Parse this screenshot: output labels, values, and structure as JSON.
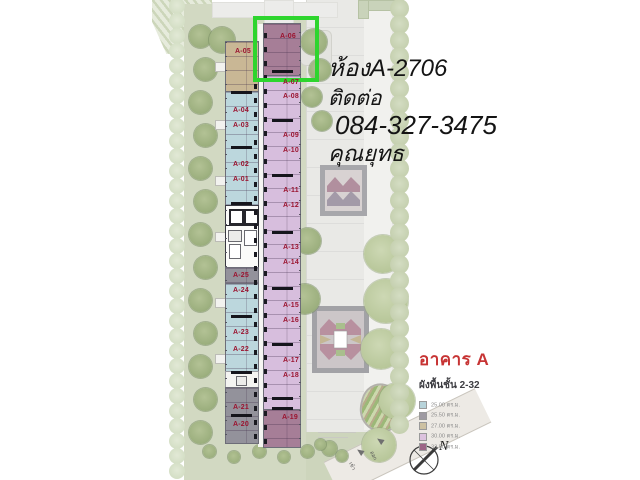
{
  "overlay": {
    "room_line": "ห้องA-2706",
    "contact_line": "ติดต่อ",
    "phone": "084-327-3475",
    "name": "คุณยุทธ"
  },
  "legend": {
    "building_title": "อาคาร A",
    "floors_subtitle": "ผังพื้นชั้น 2-32",
    "accent_color": "#c73434",
    "items": [
      {
        "label": "25.00 ตร.ม.",
        "color": "#b7d3da"
      },
      {
        "label": "25.50 ตร.ม.",
        "color": "#9e9aa2"
      },
      {
        "label": "27.00 ตร.ม.",
        "color": "#cdc1a2"
      },
      {
        "label": "30.00 ตร.ม.",
        "color": "#dcc2de"
      },
      {
        "label": "33.50 ตร.ม.",
        "color": "#9c6586"
      }
    ]
  },
  "site": {
    "compass_label": "N",
    "entrance_label": "เข้า",
    "exit_label": "ออก"
  },
  "highlight": {
    "unit": "A-06",
    "color": "#2ed52e"
  },
  "units": {
    "left": [
      {
        "id": "A-05",
        "type": "tan",
        "x": 232,
        "y": 48
      },
      {
        "id": "A-04",
        "type": "blue",
        "x": 230,
        "y": 107
      },
      {
        "id": "A-03",
        "type": "blue",
        "x": 230,
        "y": 122
      },
      {
        "id": "A-02",
        "type": "blue",
        "x": 230,
        "y": 161
      },
      {
        "id": "A-01",
        "type": "blue",
        "x": 230,
        "y": 176
      },
      {
        "id": "A-25",
        "type": "gray",
        "x": 230,
        "y": 272
      },
      {
        "id": "A-24",
        "type": "blue",
        "x": 230,
        "y": 287
      },
      {
        "id": "A-23",
        "type": "blue",
        "x": 230,
        "y": 329
      },
      {
        "id": "A-22",
        "type": "blue",
        "x": 230,
        "y": 346
      },
      {
        "id": "A-21",
        "type": "gray",
        "x": 230,
        "y": 404
      },
      {
        "id": "A-20",
        "type": "gray",
        "x": 230,
        "y": 421
      }
    ],
    "right": [
      {
        "id": "A-06",
        "type": "mauve",
        "x": 277,
        "y": 33
      },
      {
        "id": "A-07",
        "type": "purple",
        "x": 280,
        "y": 79
      },
      {
        "id": "A-08",
        "type": "purple",
        "x": 280,
        "y": 93
      },
      {
        "id": "A-09",
        "type": "purple",
        "x": 280,
        "y": 132
      },
      {
        "id": "A-10",
        "type": "purple",
        "x": 280,
        "y": 147
      },
      {
        "id": "A-11",
        "type": "purple",
        "x": 280,
        "y": 187
      },
      {
        "id": "A-12",
        "type": "purple",
        "x": 280,
        "y": 202
      },
      {
        "id": "A-13",
        "type": "purple",
        "x": 280,
        "y": 244
      },
      {
        "id": "A-14",
        "type": "purple",
        "x": 280,
        "y": 259
      },
      {
        "id": "A-15",
        "type": "purple",
        "x": 280,
        "y": 302
      },
      {
        "id": "A-16",
        "type": "purple",
        "x": 280,
        "y": 317
      },
      {
        "id": "A-17",
        "type": "purple",
        "x": 280,
        "y": 357
      },
      {
        "id": "A-18",
        "type": "purple",
        "x": 280,
        "y": 372
      },
      {
        "id": "A-19",
        "type": "mauve",
        "x": 279,
        "y": 414
      }
    ]
  }
}
